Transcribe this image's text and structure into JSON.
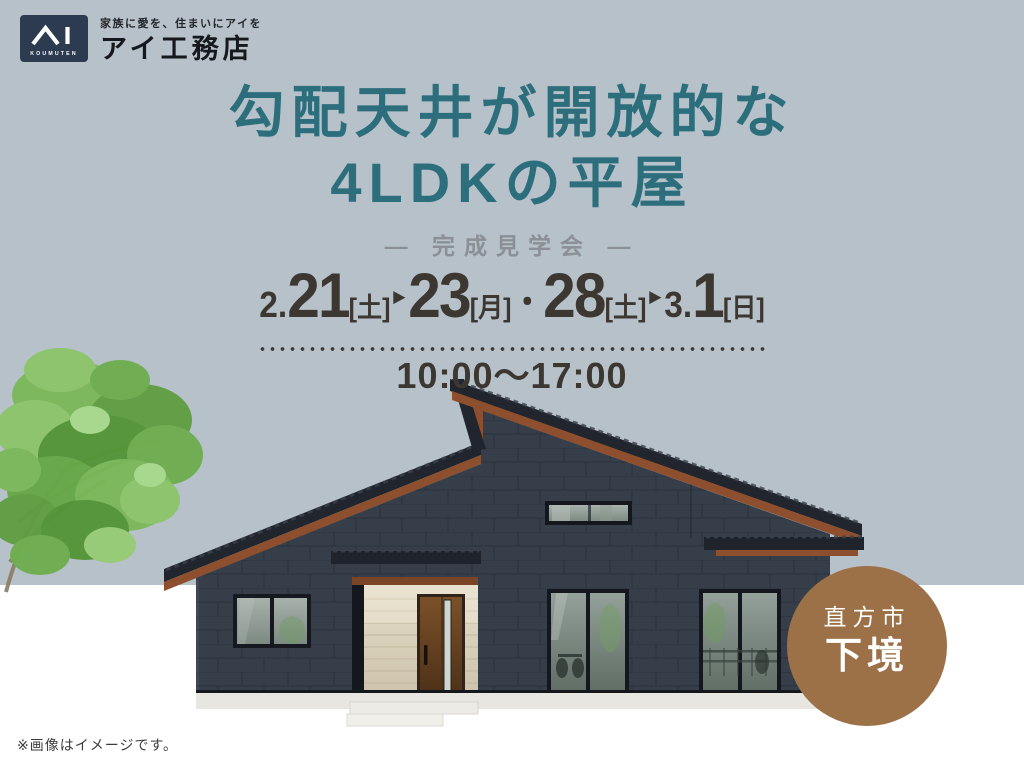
{
  "colors": {
    "background_sky": "#b7c1c9",
    "background_ground": "#ffffff",
    "title_teal": "#2d6e7d",
    "subtitle_gray": "#8a9095",
    "date_text": "#3d3732",
    "badge_brown": "#9d7147",
    "logo_navy": "#2d3b50",
    "house_wall_navy": "#363e4a",
    "roof_fascia_rust": "#8d4f2e",
    "entry_stone_beige": "#d8cfbc"
  },
  "logo": {
    "koumuten_caption": "KOUMUTEN",
    "tagline": "家族に愛を、住まいにアイを",
    "company_name": "アイ工務店"
  },
  "title": {
    "line1": "勾配天井が開放的な",
    "line2": "4LDKの平屋"
  },
  "subtitle": "— 完成見学会 —",
  "event": {
    "dates_full": "2.21[土]▶23[月]・28[土]▶3.1[日]",
    "date_segments": [
      {
        "text": "2."
      },
      {
        "text": "21"
      },
      {
        "text": "[土]"
      },
      {
        "text": "▶"
      },
      {
        "text": "23"
      },
      {
        "text": "[月]"
      },
      {
        "text": "・"
      },
      {
        "text": "28"
      },
      {
        "text": "[土]"
      },
      {
        "text": "▶"
      },
      {
        "text": "3."
      },
      {
        "text": "1"
      },
      {
        "text": "[日]"
      }
    ],
    "time": "10:00〜17:00"
  },
  "location": {
    "city": "直方市",
    "district": "下境"
  },
  "image_note": "※画像はイメージです。"
}
